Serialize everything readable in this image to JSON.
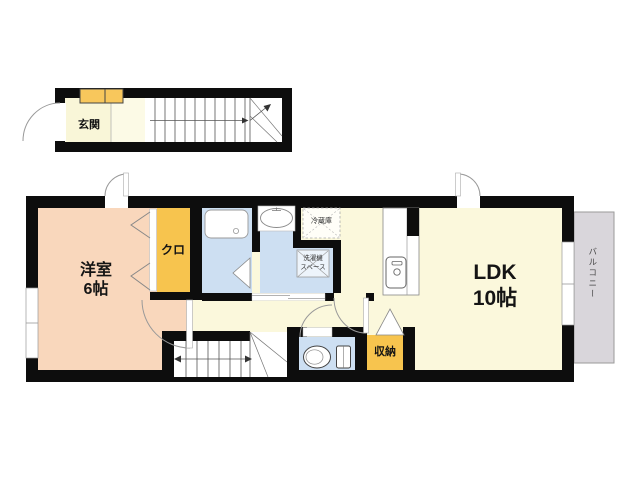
{
  "plan": {
    "type": "apartment-floor-plan",
    "labels": {
      "genkan": "玄関",
      "west_room_name": "洋室",
      "west_room_size": "6帖",
      "closet": "クロ",
      "fridge": "冷蔵庫",
      "washer_line1": "洗濯機",
      "washer_line2": "スペース",
      "ldk_name": "LDK",
      "ldk_size": "10帖",
      "storage": "収納",
      "balcony": "バルコニー"
    },
    "colors": {
      "wall": "#0d0d0d",
      "west_room_floor": "#f9d7bc",
      "ldk_floor": "#fbf8dc",
      "closet_fill": "#f7c44e",
      "wet_area_fill": "#cddff2",
      "balcony_fill": "#d9d6db",
      "shoe_cabinet_fill": "#f8c75c"
    }
  }
}
